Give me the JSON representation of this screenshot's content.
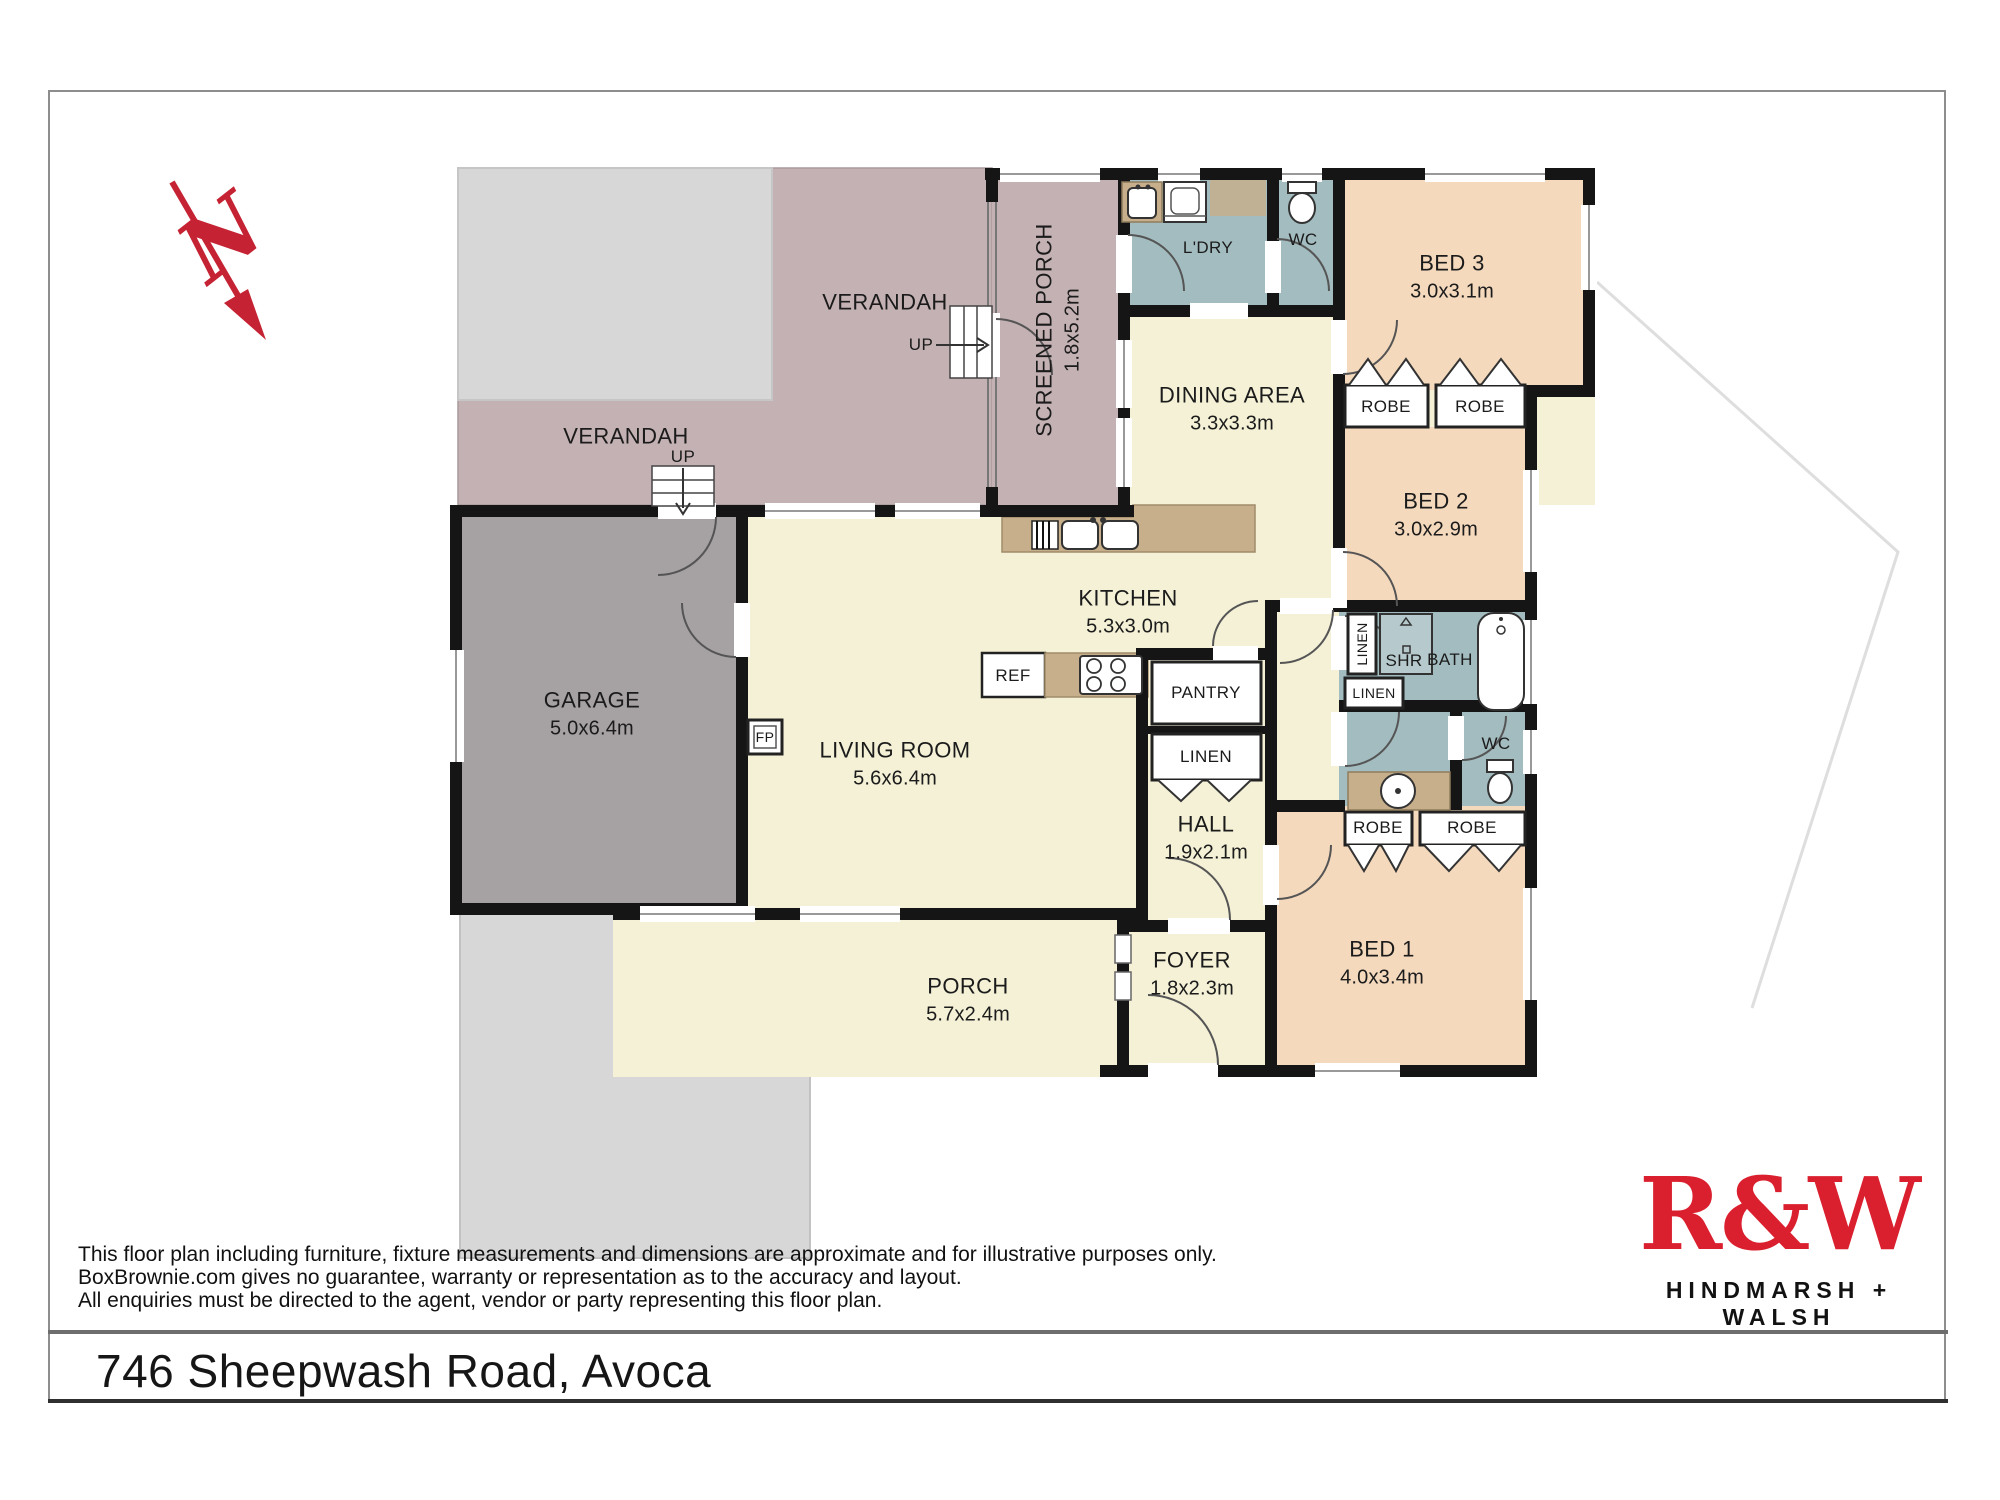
{
  "compass": {
    "label": "N"
  },
  "labels": {
    "verandah_top": {
      "name": "VERANDAH"
    },
    "verandah_side": {
      "name": "VERANDAH"
    },
    "up_side": {
      "name": "UP"
    },
    "up_porch": {
      "name": "UP"
    },
    "screened_porch": {
      "name": "SCREENED PORCH",
      "dims": "1.8x5.2m"
    },
    "laundry": {
      "name": "L'DRY"
    },
    "wc_top": {
      "name": "WC"
    },
    "bed3": {
      "name": "BED 3",
      "dims": "3.0x3.1m"
    },
    "robe_bed3_left": {
      "name": "ROBE"
    },
    "robe_bed3_right": {
      "name": "ROBE"
    },
    "dining": {
      "name": "DINING AREA",
      "dims": "3.3x3.3m"
    },
    "bed2": {
      "name": "BED 2",
      "dims": "3.0x2.9m"
    },
    "kitchen": {
      "name": "KITCHEN",
      "dims": "5.3x3.0m"
    },
    "linen_bath": {
      "name": "LINEN"
    },
    "shower": {
      "name": "SHR"
    },
    "bath": {
      "name": "BATH"
    },
    "linen_mid": {
      "name": "LINEN"
    },
    "wc_ensuite": {
      "name": "WC"
    },
    "pantry": {
      "name": "PANTRY"
    },
    "linen_hall": {
      "name": "LINEN"
    },
    "hall": {
      "name": "HALL",
      "dims": "1.9x2.1m"
    },
    "robe_bed1_left": {
      "name": "ROBE"
    },
    "robe_bed1_right": {
      "name": "ROBE"
    },
    "bed1": {
      "name": "BED 1",
      "dims": "4.0x3.4m"
    },
    "foyer": {
      "name": "FOYER",
      "dims": "1.8x2.3m"
    },
    "porch": {
      "name": "PORCH",
      "dims": "5.7x2.4m"
    },
    "garage": {
      "name": "GARAGE",
      "dims": "5.0x6.4m"
    },
    "living": {
      "name": "LIVING ROOM",
      "dims": "5.6x6.4m"
    },
    "ref": {
      "name": "REF"
    },
    "fp": {
      "name": "FP"
    }
  },
  "footer": {
    "disclaimer": [
      "This floor plan including furniture, fixture measurements and dimensions are approximate and for illustrative purposes only.",
      "BoxBrownie.com gives no guarantee, warranty or representation as to the accuracy and layout.",
      "All enquiries must be directed to the agent, vendor or party representing this floor plan."
    ],
    "address": "746 Sheepwash Road, Avoca"
  },
  "logo": {
    "name": "R&W",
    "tagline": "HINDMARSH + WALSH"
  },
  "colors": {
    "brand_red": "#da1f2e",
    "compass_red": "#c52333",
    "outdoor_mauve": "#c4b1b3",
    "porch_mauve": "#bcabae",
    "patio_gray": "#d7d7d7",
    "interior_cream": "#f4f1d6",
    "bedroom_peach": "#f4d9bd",
    "wet_area_blue": "#a3bcbf",
    "garage_gray": "#a6a1a3",
    "bench_tan": "#c7af8c",
    "wall_black": "#151515"
  }
}
